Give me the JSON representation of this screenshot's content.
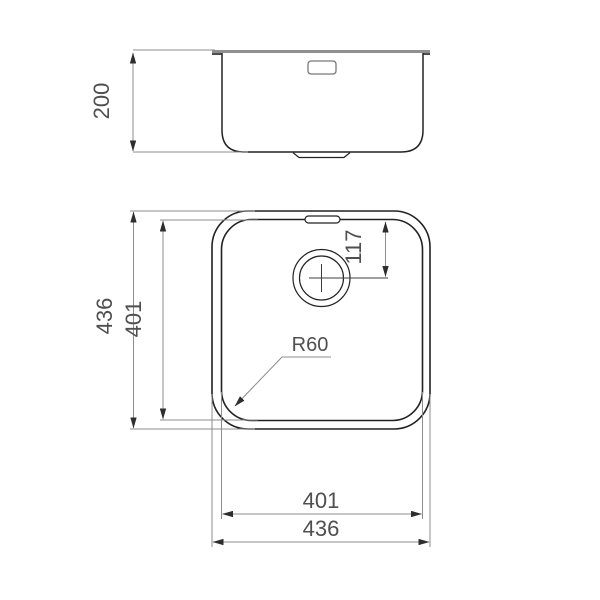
{
  "title": "sink-technical-drawing",
  "dims": {
    "depth": "200",
    "overall_vertical": "436",
    "bowl_vertical": "401",
    "corner_radius": "R60",
    "drain_offset": "117",
    "bowl_horizontal": "401",
    "overall_horizontal": "436"
  },
  "colors": {
    "outline": "#222222",
    "dimension": "#8c8c8c",
    "arrow": "#2e2e2e",
    "text": "#4f4f4f",
    "countertop": "#8f8f8f",
    "background": "#ffffff"
  }
}
